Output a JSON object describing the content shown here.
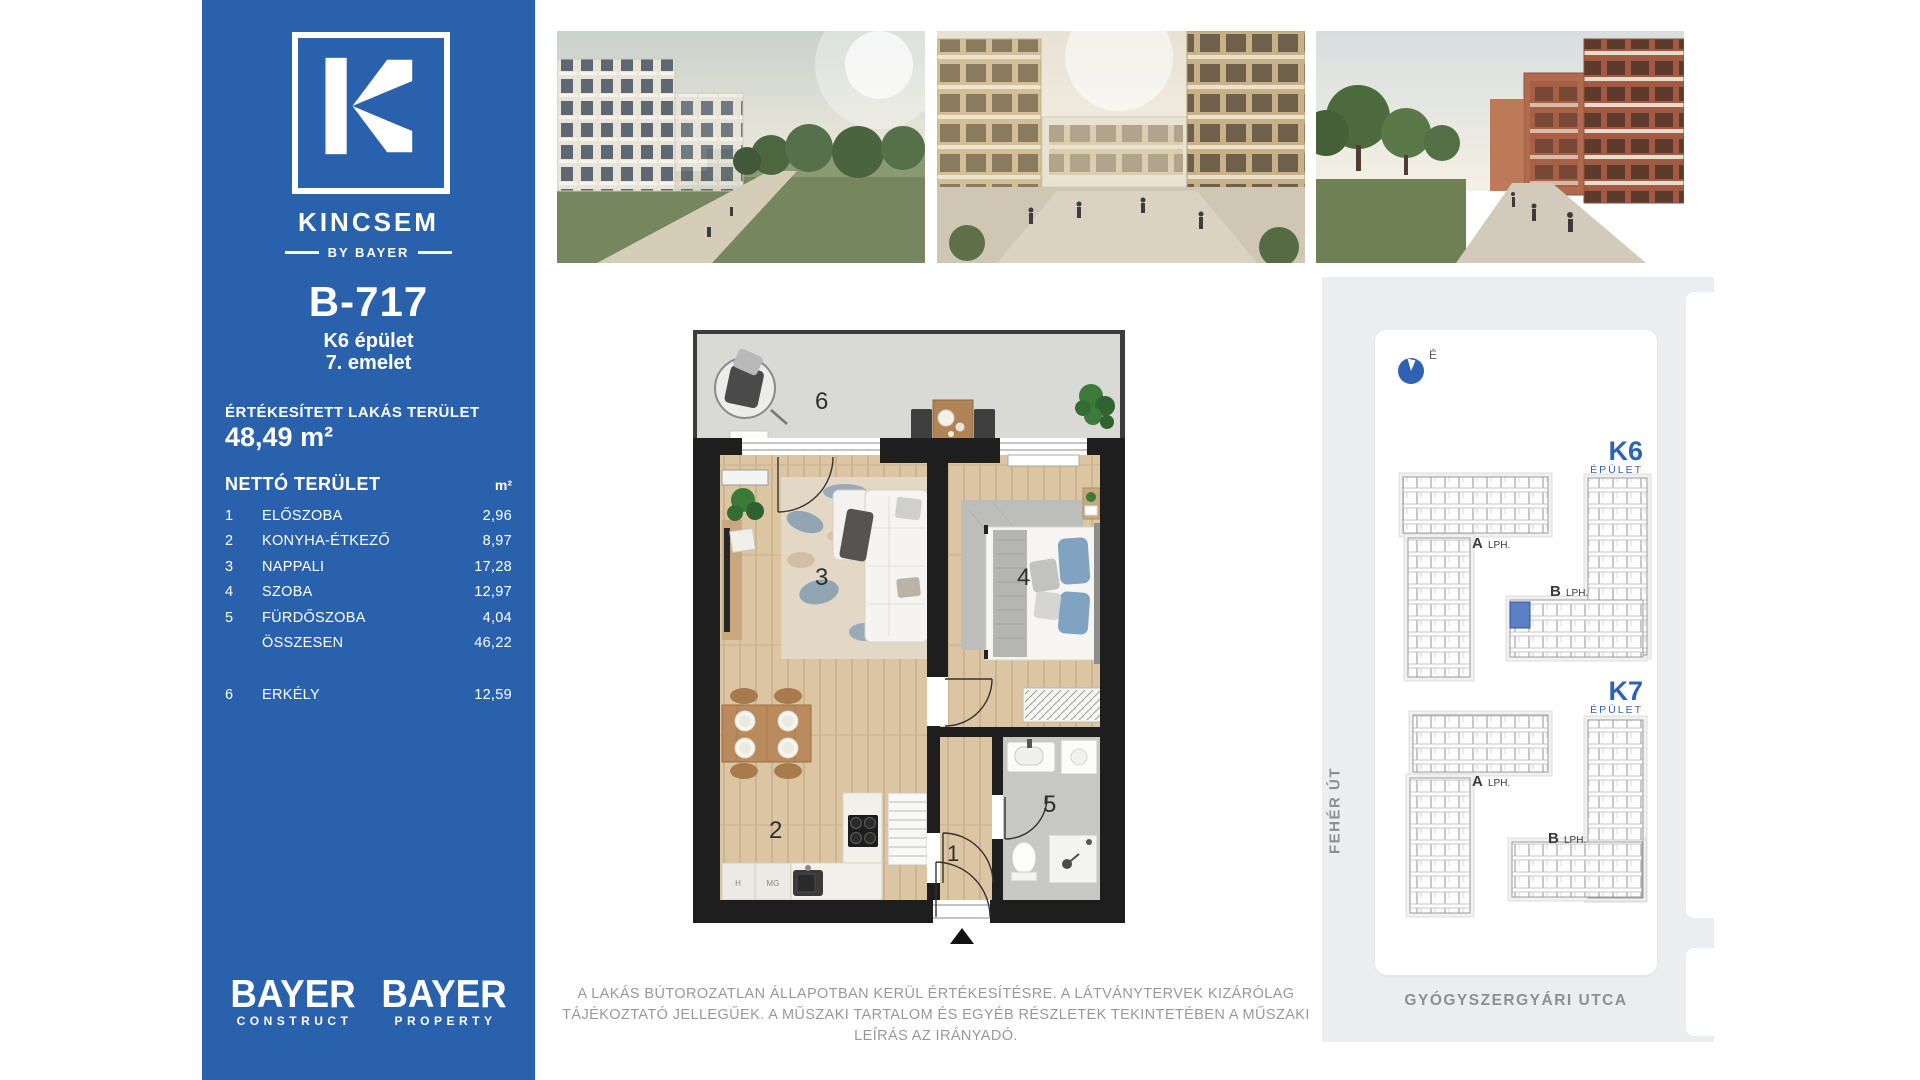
{
  "colors": {
    "brand_blue": "#2a61ac",
    "accent_blue": "#2f64b2",
    "panel_gray": "#ebedef",
    "muted_text_gray": "#98989a",
    "highlight_unit_blue": "#5b7fc4"
  },
  "sidebar": {
    "logo_letter": "K",
    "brand_name": "KINCSEM",
    "brand_byline": "BY BAYER",
    "unit_id": "B-717",
    "building": "K6 épület",
    "floor": "7. emelet",
    "sold_area_label": "ÉRTÉKESÍTETT LAKÁS TERÜLET",
    "sold_area_value": "48,49 m²",
    "net_area_label": "NETTÓ TERÜLET",
    "net_area_unit": "m²",
    "rows": [
      {
        "num": "1",
        "label": "ELŐSZOBA",
        "value": "2,96"
      },
      {
        "num": "2",
        "label": "KONYHA-ÉTKEZŐ",
        "value": "8,97"
      },
      {
        "num": "3",
        "label": "NAPPALI",
        "value": "17,28"
      },
      {
        "num": "4",
        "label": "SZOBA",
        "value": "12,97"
      },
      {
        "num": "5",
        "label": "FÜRDŐSZOBA",
        "value": "4,04"
      },
      {
        "num": "",
        "label": "ÖSSZESEN",
        "value": "46,22"
      },
      {
        "num": "6",
        "label": "ERKÉLY",
        "value": "12,59"
      }
    ],
    "logos": [
      {
        "title": "BAYER",
        "subtitle": "CONSTRUCT"
      },
      {
        "title": "BAYER",
        "subtitle": "PROPERTY"
      }
    ]
  },
  "plan": {
    "rooms": {
      "balcony": "6",
      "living": "3",
      "bedroom": "4",
      "kitchen": "2",
      "hall": "1",
      "bath": "5"
    },
    "appliances": {
      "h": "H",
      "mg": "MG"
    }
  },
  "site": {
    "compass": "É",
    "k6": "K6",
    "k7": "K7",
    "epulet": "ÉPÜLET",
    "a": "A",
    "b": "B",
    "lph": "LPH.",
    "street_left": "FEHÉR ÚT",
    "street_bottom": "GYÓGYSZERGYÁRI UTCA"
  },
  "disclaimer": "A LAKÁS BÚTOROZATLAN ÁLLAPOTBAN KERÜL ÉRTÉKESÍTÉSRE. A LÁTVÁNYTERVEK KIZÁRÓLAG TÁJÉKOZTATÓ JELLEGŰEK. A MŰSZAKI TARTALOM ÉS EGYÉB RÉSZLETEK TEKINTETÉBEN A MŰSZAKI LEÍRÁS AZ IRÁNYADÓ."
}
